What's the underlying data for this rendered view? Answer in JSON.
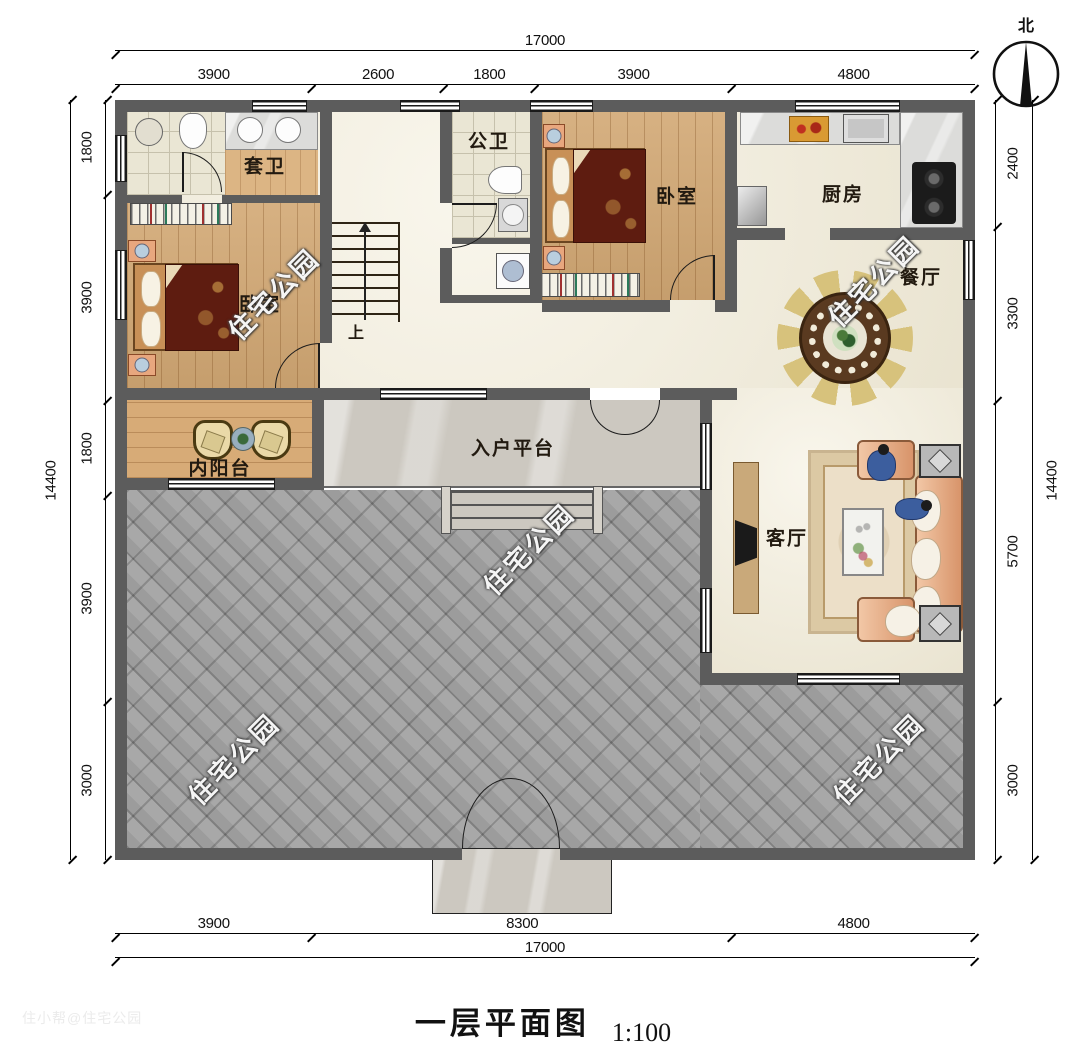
{
  "title": {
    "text": "一层平面图",
    "scale": "1:100"
  },
  "compass": {
    "north": "北"
  },
  "watermark": {
    "text": "住宅公园",
    "credit": "住小帮@住宅公园"
  },
  "dimensions": {
    "top": {
      "total": [
        17000
      ],
      "segments": [
        3900,
        2600,
        1800,
        3900,
        4800
      ]
    },
    "bottom": {
      "total": [
        17000
      ],
      "segments": [
        3900,
        8300,
        4800
      ]
    },
    "left": {
      "total": [
        14400
      ],
      "segments": [
        1800,
        3900,
        1800,
        3900,
        3000
      ]
    },
    "right": {
      "total": [
        14400
      ],
      "segments": [
        2400,
        3300,
        5700,
        3000
      ]
    }
  },
  "rooms": {
    "ensuite_bath": "套卫",
    "public_bath": "公卫",
    "bedroom_left": "卧室",
    "bedroom_top": "卧室",
    "kitchen": "厨房",
    "dining": "餐厅",
    "inner_balcony": "内阳台",
    "entry_platform": "入户平台",
    "living": "客厅",
    "stairs_up": "上"
  },
  "colors": {
    "wall": "#5c5c5c",
    "courtyard": "#9c9c9c",
    "wood_floor": "#d2a874",
    "interior_floor": "#f3edd9",
    "blanket": "#5e1c10",
    "sofa": "#e8b393",
    "dim_line": "#000000"
  }
}
